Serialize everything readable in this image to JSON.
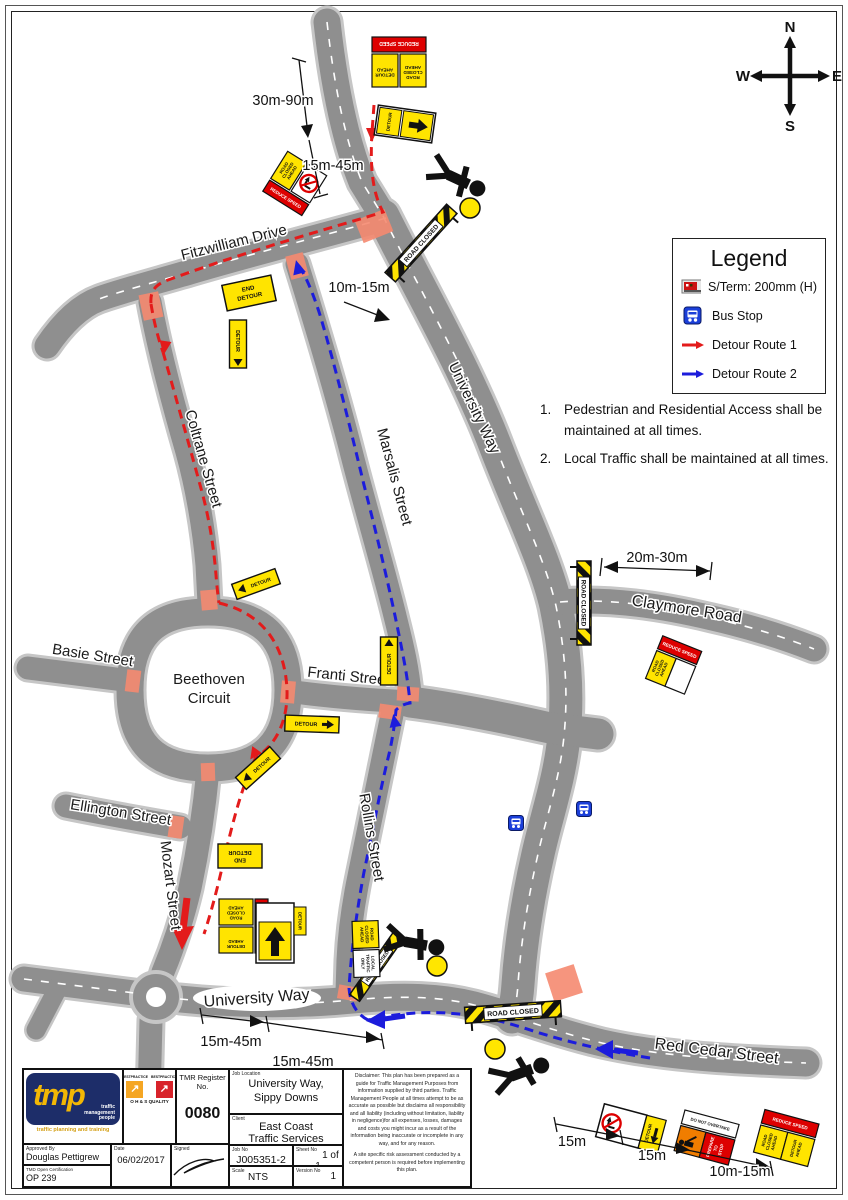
{
  "compass": {
    "n": "N",
    "e": "E",
    "s": "S",
    "w": "W"
  },
  "legend": {
    "title": "Legend",
    "items": [
      {
        "label": "S/Term: 200mm (H)"
      },
      {
        "label": "Bus Stop"
      },
      {
        "label": "Detour Route 1"
      },
      {
        "label": "Detour Route 2"
      }
    ]
  },
  "notes": [
    {
      "num": "1.",
      "text": "Pedestrian and Residential Access shall be maintained at all times."
    },
    {
      "num": "2.",
      "text": "Local Traffic shall be maintained at all times."
    }
  ],
  "streets": {
    "fitzwilliam": "Fitzwilliam Drive",
    "coltrane": "Coltrane Street",
    "marsalis": "Marsalis Street",
    "university_way_main": "University Way",
    "university_way_south": "University Way",
    "beethoven_line1": "Beethoven",
    "beethoven_line2": "Circuit",
    "basie": "Basie Street",
    "franti": "Franti Street",
    "rollins": "Rollins Street",
    "ellington": "Ellington Street",
    "mozart": "Mozart Street",
    "claymore": "Claymore Road",
    "red_cedar": "Red Cedar Street"
  },
  "measurements": {
    "top1": "30m-90m",
    "top2": "15m-45m",
    "top3": "10m-15m",
    "claymore": "20m-30m",
    "bottom1": "15m-45m",
    "bottom2": "15m-45m",
    "redcedar1": "15m",
    "redcedar2": "15m",
    "redcedar3": "10m-15m"
  },
  "signs": {
    "road": "ROAD",
    "closed": "CLOSED",
    "ahead": "AHEAD",
    "detour": "DETOUR",
    "end": "END",
    "reduce_speed": "REDUCE SPEED",
    "road_closed": "ROAD CLOSED",
    "local": "LOCAL",
    "traffic": "TRAFFIC",
    "only": "ONLY",
    "prepare": "PREPARE",
    "to": "TO",
    "stop": "STOP",
    "do_not_overtake": "DO NOT OVERTAKE"
  },
  "title_block": {
    "logo": {
      "brand": "tmp",
      "word1": "traffic",
      "word2": "management",
      "word3": "people",
      "tagline": "traffic planning and training"
    },
    "badges": {
      "header1": "BESTPRACTICE",
      "header2": "BESTPRACTICE",
      "caption": "O H & S QUALITY"
    },
    "tmr_label": "TMR Register No.",
    "tmr_value": "0080",
    "cells": {
      "job_location_label": "Job Location",
      "job_location_value1": "University Way,",
      "job_location_value2": "Sippy Downs",
      "client_label": "Client",
      "client_value1": "East Coast",
      "client_value2": "Traffic Services",
      "job_no_label": "Job No",
      "job_no_value": "J005351-2",
      "sheet_label": "Sheet No",
      "sheet_value": "1 of 1",
      "scale_label": "Scale",
      "scale_value": "NTS",
      "version_label": "Version No",
      "version_value": "1",
      "approved_label": "Approved By",
      "approved_value": "Douglas Pettigrew",
      "date_label": "Date",
      "date_value": "06/02/2017",
      "signed_label": "Signed",
      "cert_label": "TMD Open Certification",
      "cert_value": "OP 239"
    },
    "disclaimer_p1": "Disclaimer: This plan has been prepared as a guide for Traffic Management Purposes from information supplied by third parties. Traffic Management People at all times attempt to be as accurate as possible but disclaims all responsibility and all liability (including without limitation, liability in negligence)for all expenses, losses, damages and costs you might incur as a result of the information being inaccurate or incomplete in any way, and for any reason.",
    "disclaimer_p2": "A site specific risk assessment conducted by a competent person is required before implementing this plan."
  },
  "colors": {
    "route1": "#e31b1b",
    "route2": "#1c1cdc",
    "road": "#8f8f8f",
    "closure": "#f58970",
    "sign_yellow": "#ffe400",
    "sign_red": "#dd0000",
    "sign_orange": "#f07d00",
    "bus_blue": "#1b3fd9"
  }
}
